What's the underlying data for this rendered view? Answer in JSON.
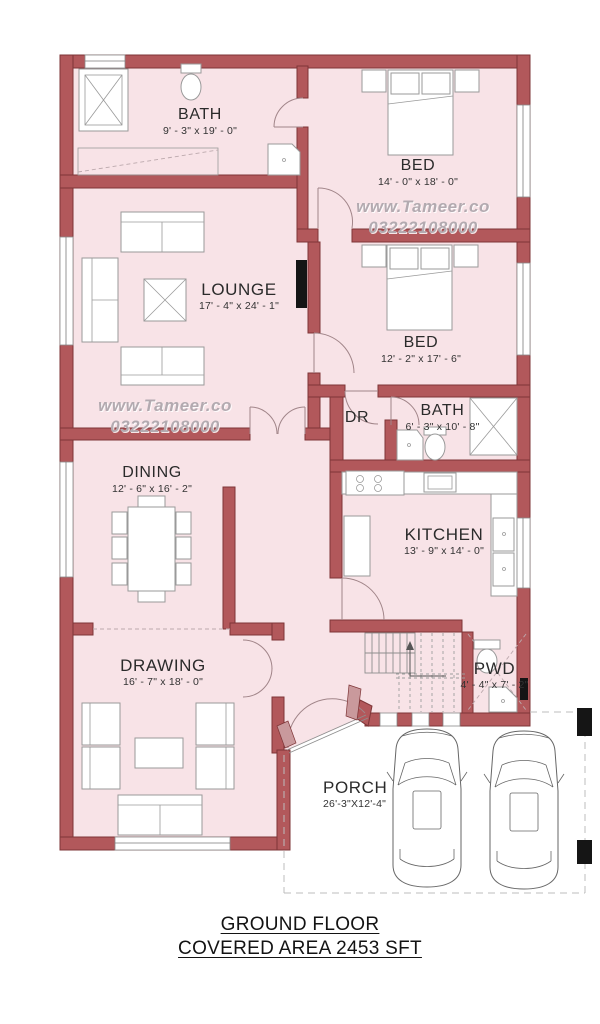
{
  "plan": {
    "watermark": {
      "site": "www.Tameer.co",
      "phone": "03222108000"
    },
    "rooms": {
      "bath1": {
        "name": "BATH",
        "dims": "9' - 3\" x 19' - 0\""
      },
      "bed1": {
        "name": "BED",
        "dims": "14' - 0\" x 18' - 0\""
      },
      "lounge": {
        "name": "LOUNGE",
        "dims": "17' - 4\" x 24' - 1\""
      },
      "bed2": {
        "name": "BED",
        "dims": "12' - 2\" x 17' - 6\""
      },
      "dr": {
        "name": "DR"
      },
      "bath2": {
        "name": "BATH",
        "dims": "6' - 3\" x 10' - 8\""
      },
      "dining": {
        "name": "DINING",
        "dims": "12' - 6\" x 16' - 2\""
      },
      "kitchen": {
        "name": "KITCHEN",
        "dims": "13' - 9\" x 14' - 0\""
      },
      "drawing": {
        "name": "DRAWING",
        "dims": "16' - 7\" x 18' - 0\""
      },
      "pwd": {
        "name": "PWD",
        "dims": "4' - 4\" x 7' - 2\""
      },
      "porch": {
        "name": "PORCH",
        "dims": "26'-3\"X12'-4\""
      }
    },
    "footer": {
      "line1": "GROUND FLOOR",
      "line2": "COVERED AREA 2453 SFT"
    },
    "colors": {
      "wall": "#b2585b",
      "wall_outline": "#7e3537",
      "floor": "#f8e3e7",
      "watermark": "#b3aab0",
      "accent_black": "#151515"
    }
  }
}
